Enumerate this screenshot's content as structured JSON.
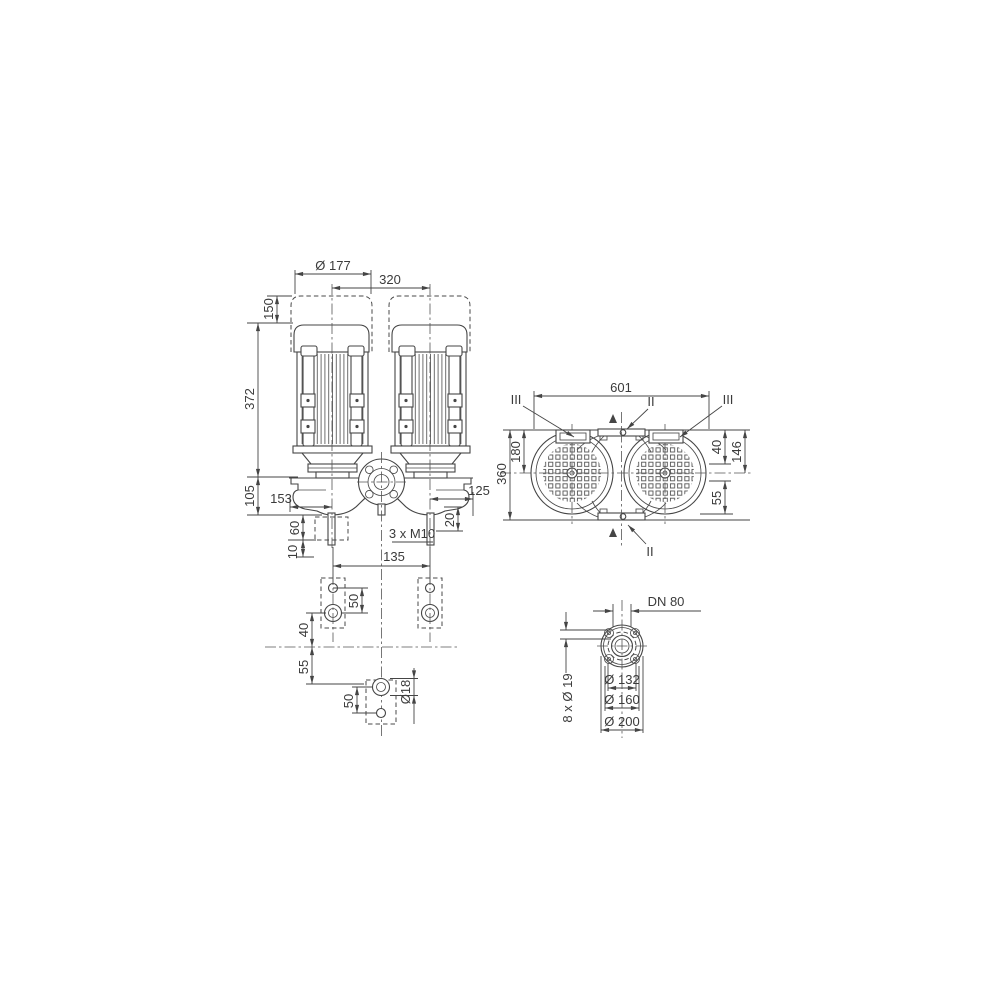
{
  "colors": {
    "line": "#454545",
    "text": "#3b3b3b",
    "background": "#ffffff"
  },
  "front_view": {
    "motor_diameter": "Ø 177",
    "motor_spacing": "320",
    "dim_150": "150",
    "dim_372": "372",
    "dim_105": "105",
    "dim_153": "153",
    "dim_60": "60",
    "dim_10": "10",
    "dim_125": "125",
    "dim_20": "20",
    "thread_note": "3 x M10",
    "dim_135": "135"
  },
  "top_view": {
    "overall_width": "601",
    "section_marker_left": "III",
    "section_marker_right": "III",
    "section_marker_top": "II",
    "section_marker_bottom": "II",
    "dim_360": "360",
    "dim_180": "180",
    "dim_40": "40",
    "dim_146": "146",
    "dim_55": "55"
  },
  "foot_view": {
    "dim_50_upper": "50",
    "dim_40": "40",
    "dim_55": "55",
    "dim_50_lower": "50",
    "hole_diameter": "Ø18"
  },
  "flange_view": {
    "nominal_diameter": "DN 80",
    "bolt_holes": "8 x Ø 19",
    "d132": "Ø 132",
    "d160": "Ø 160",
    "d200": "Ø 200"
  }
}
